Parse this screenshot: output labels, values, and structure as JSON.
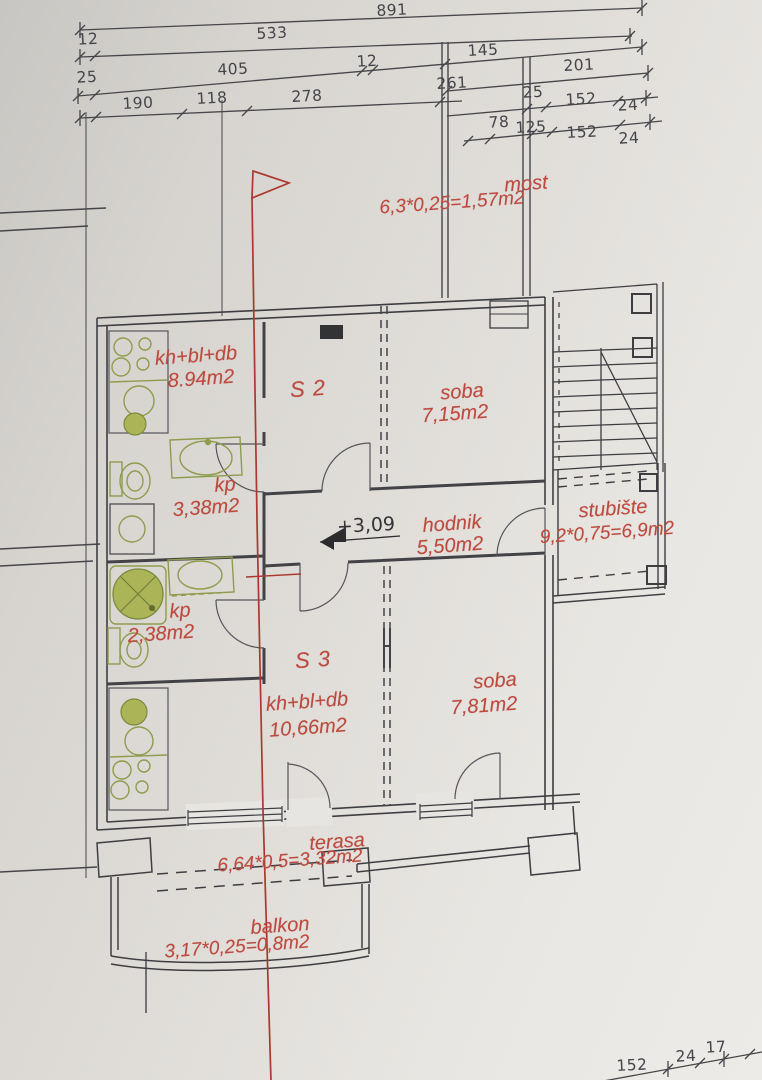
{
  "document": {
    "kind": "architectural floor plan (scanned)"
  },
  "palette": {
    "paper": "#e0ddd9",
    "ink": "#45454a",
    "red": "#bd4a3f",
    "section_red": "#aa382e",
    "fixture_green": "#8f9c4e",
    "fixture_fill": "#abb557"
  },
  "dims": {
    "row1": [
      "891"
    ],
    "row2": [
      "12",
      "533"
    ],
    "row3": [
      "25",
      "405",
      "12",
      "145",
      "201"
    ],
    "row3_right": [
      "261",
      "25",
      "152",
      "24"
    ],
    "row4": [
      "190",
      "118",
      "278"
    ],
    "row4_right": [
      "78",
      "125",
      "152",
      "24"
    ],
    "bottom_right": [
      "152",
      "24",
      "17"
    ]
  },
  "rooms": {
    "most": {
      "name": "most",
      "formula": "6,3*0,25=1,57m2"
    },
    "kitchen_upper": {
      "name": "kh+bl+db",
      "area": "8.94m2"
    },
    "unit_s2": {
      "name": "S 2"
    },
    "soba_upper": {
      "name": "soba",
      "area": "7,15m2"
    },
    "bath_upper": {
      "name": "kp",
      "area": "3,38m2"
    },
    "hodnik": {
      "name": "hodnik",
      "area": "5,50m2"
    },
    "stubiste": {
      "name": "stubište",
      "formula": "9,2*0,75=6,9m2"
    },
    "bath_lower": {
      "name": "kp",
      "area": "2,38m2"
    },
    "unit_s3": {
      "name": "S 3"
    },
    "kitchen_lower": {
      "name": "kh+bl+db",
      "area": "10,66m2"
    },
    "soba_lower": {
      "name": "soba",
      "area": "7,81m2"
    },
    "terasa": {
      "name": "terasa",
      "formula": "6,64*0,5=3,32m2"
    },
    "balkon": {
      "name": "balkon",
      "formula": "3,17*0,25=0,8m2"
    }
  },
  "markers": {
    "level": "+3,09"
  }
}
